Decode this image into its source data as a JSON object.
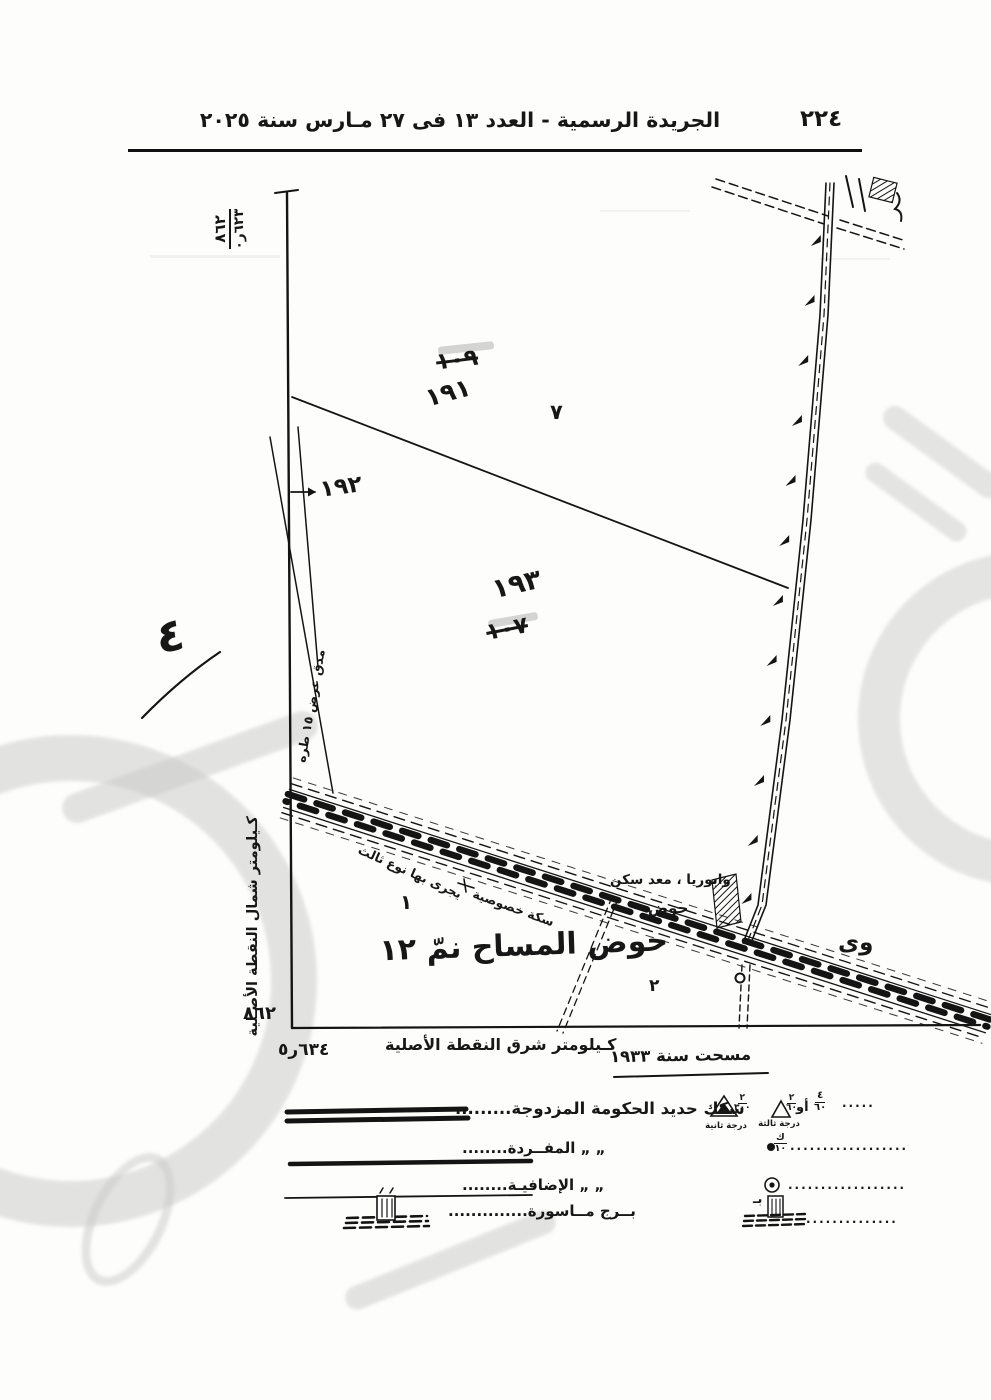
{
  "header": {
    "page_number": "٢٢٤",
    "title": "الجريدة الرسمية - العدد ١٣ فى ٢٧ مـارس سنة ٢٠٢٥"
  },
  "map": {
    "axes": {
      "nw_top": "٨٦٢",
      "nw_bottom": "٦٢٣ر٠",
      "west_label": "كـيلومتر شمال النقطة الأصـلية",
      "sw_value": "٨٦٢",
      "south_label": "كـيلومتر شرق النقطة الأصلية",
      "se_value": "٦٣٤ر٥"
    },
    "numbers": {
      "struck_top": "١٠٩",
      "n191": "١٩١",
      "n7": "٧",
      "n192": "١٩٢",
      "n193": "١٩٣",
      "struck_mid": "١٠٧",
      "margin_note": "٤",
      "n1": "١",
      "n2": "٢"
    },
    "labels": {
      "channel": "مدق عرض ١٥ طره",
      "railway_type": "يجرى بها نوع ثالث",
      "railway_private": "سكة خصوصية",
      "pump": "وابوريا ، معد سكن",
      "basin_small": "حوض",
      "basin_title": "حوض المساح نمّ ١٢",
      "edge_partial": "وى",
      "surveyed": "مسحت سنة ١٩٣٣"
    }
  },
  "legend": {
    "left_rows": [
      {
        "label": "سكك حديد الحكومة المزدوجة",
        "leader": "........."
      },
      {
        "label": "„   „   المفــردة",
        "leader": "........"
      },
      {
        "label": "„   „   الإضافيـة",
        "leader": "........"
      },
      {
        "label": "بــرج مــاسورة",
        "leader": ".............."
      }
    ],
    "right_rows": {
      "row1": {
        "frac_a_top": "٤",
        "frac_a_bottom": "٦٠",
        "or": "أو",
        "frac_b_top": "٢",
        "frac_b_bottom": "٦٠",
        "tri_open_label": "درجة ثالثة",
        "frac_c_top": "٢",
        "frac_c_bottom": "٣٠٠",
        "tri_double_label": "درجة ثانية",
        "leader": "....."
      },
      "row2": {
        "frac_top": "ك",
        "frac_bottom": "١٠",
        "leader": ".................."
      },
      "row3": {
        "leader": ".................."
      },
      "row4": {
        "prefix": "بـ",
        "leader": ".............."
      }
    }
  }
}
